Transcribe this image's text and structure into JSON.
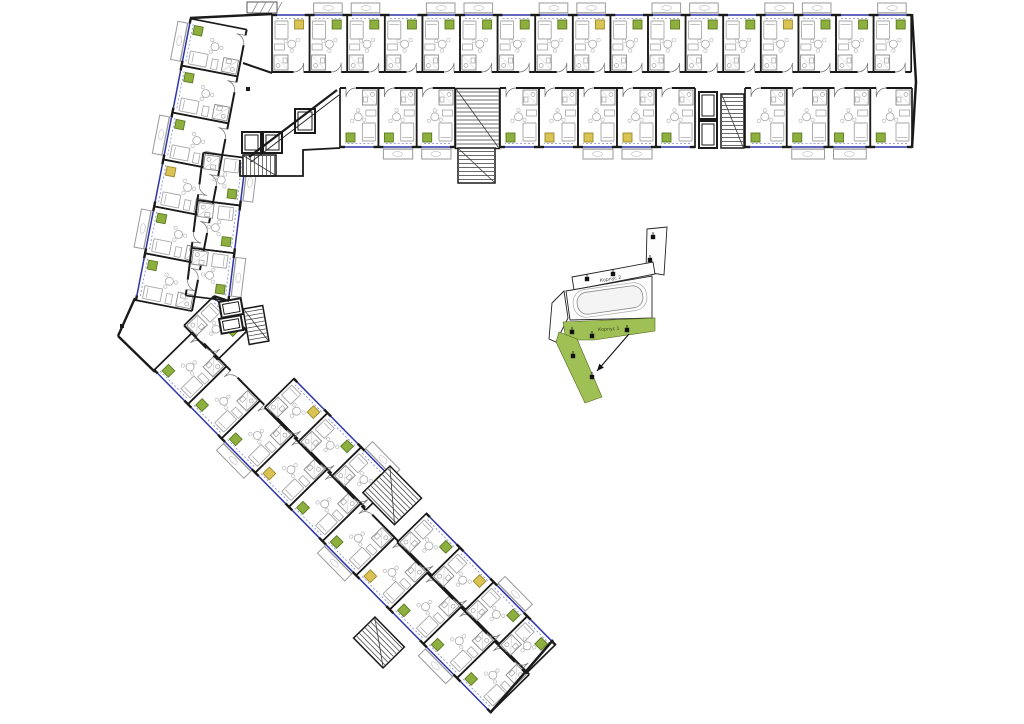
{
  "title": "residential-floor-plan",
  "palette": {
    "wall": "#1a1a1a",
    "furn": "#a6a6a6",
    "furn_light": "#bfbfbf",
    "blue": "#2e35a8",
    "blue_dash": "#8089d6",
    "kitchen_green": "#8caf3e",
    "kitchen_green_dark": "#5d7a22",
    "kitchen_yellow": "#d9c355",
    "kitchen_yellow_dark": "#9b8a2c",
    "stair": "#3a3a3a",
    "minimap_green": "#9fc055",
    "minimap_green_dark": "#55661f",
    "bg": "#ffffff"
  },
  "plan": {
    "rows": [
      {
        "name": "top-wing-north-row",
        "o": [
          272,
          14
        ],
        "a": 0,
        "w": 37.6,
        "d": 58,
        "units": [
          {
            "x": 0,
            "k": "y",
            "bal": false
          },
          {
            "x": 37.6,
            "k": "g",
            "bal": true
          },
          {
            "x": 75.2,
            "k": "g",
            "bal": true
          },
          {
            "x": 112.8,
            "k": "g",
            "bal": false
          },
          {
            "x": 150.4,
            "k": "g",
            "bal": true
          },
          {
            "x": 188,
            "k": "g",
            "bal": true
          },
          {
            "x": 225.6,
            "k": "g",
            "bal": false
          },
          {
            "x": 263.2,
            "k": "g",
            "bal": true
          },
          {
            "x": 300.8,
            "k": "y",
            "bal": true
          },
          {
            "x": 338.4,
            "k": "g",
            "bal": false
          },
          {
            "x": 376,
            "k": "g",
            "bal": true
          },
          {
            "x": 413.6,
            "k": "g",
            "bal": true
          },
          {
            "x": 451.2,
            "k": "g",
            "bal": false
          },
          {
            "x": 488.8,
            "k": "y",
            "bal": true
          },
          {
            "x": 526.4,
            "k": "g",
            "bal": true
          },
          {
            "x": 564,
            "k": "g",
            "bal": false
          },
          {
            "x": 601.6,
            "k": "g",
            "bal": true
          }
        ]
      },
      {
        "name": "top-wing-south-row",
        "o": [
          912,
          148
        ],
        "a": 180,
        "w": 39,
        "d": 60,
        "units": [
          {
            "x": 0,
            "w": 41.75,
            "k": "g",
            "bal": false
          },
          {
            "x": 41.75,
            "w": 41.75,
            "k": "g",
            "bal": true
          },
          {
            "x": 83.5,
            "w": 41.75,
            "k": "g",
            "bal": true
          },
          {
            "x": 125.25,
            "w": 41.75,
            "k": "g",
            "bal": false
          },
          {
            "x": 217,
            "k": "g",
            "bal": false
          },
          {
            "x": 256,
            "k": "y",
            "bal": true
          },
          {
            "x": 295,
            "k": "y",
            "bal": true
          },
          {
            "x": 334,
            "k": "y",
            "bal": false
          },
          {
            "x": 373,
            "k": "g",
            "bal": false
          },
          {
            "x": 457,
            "w": 38.3,
            "k": "g",
            "bal": true
          },
          {
            "x": 495.3,
            "w": 38.3,
            "k": "g",
            "bal": true
          },
          {
            "x": 533.6,
            "w": 38.4,
            "k": "g",
            "bal": false
          }
        ]
      },
      {
        "name": "upper-diagonal-outer-row",
        "o": [
          135,
          300
        ],
        "a": -79,
        "w": 47.8,
        "d": 58,
        "units": [
          {
            "x": 0,
            "k": "g",
            "bal": false
          },
          {
            "x": 47.8,
            "k": "g",
            "bal": true
          },
          {
            "x": 95.6,
            "k": "y",
            "bal": false
          },
          {
            "x": 143.4,
            "k": "g",
            "bal": true
          },
          {
            "x": 191.2,
            "k": "g",
            "bal": false
          },
          {
            "x": 239,
            "k": "g",
            "bal": true
          }
        ]
      },
      {
        "name": "upper-diagonal-inner-row",
        "o": [
          247,
          158
        ],
        "a": 97,
        "w": 48,
        "d": 44,
        "units": [
          {
            "x": 0,
            "k": "g",
            "bal": true
          },
          {
            "x": 48,
            "k": "g",
            "bal": false
          },
          {
            "x": 96,
            "k": "g",
            "bal": true
          }
        ]
      },
      {
        "name": "lower-diagonal-outer-row",
        "o": [
          490,
          713
        ],
        "a": -134.5,
        "w": 48,
        "d": 55,
        "units": [
          {
            "x": 0,
            "k": "g",
            "bal": false
          },
          {
            "x": 48,
            "k": "g",
            "bal": true
          },
          {
            "x": 96,
            "k": "g",
            "bal": false
          },
          {
            "x": 144,
            "k": "y",
            "bal": false
          },
          {
            "x": 192,
            "k": "g",
            "bal": true
          },
          {
            "x": 240,
            "k": "g",
            "bal": false
          },
          {
            "x": 288,
            "k": "y",
            "bal": false
          },
          {
            "x": 336,
            "k": "g",
            "bal": true
          },
          {
            "x": 384,
            "k": "g",
            "bal": false
          },
          {
            "x": 432,
            "k": "g",
            "bal": false
          }
        ]
      },
      {
        "name": "lower-diagonal-inner-row",
        "o": [
          214,
          296
        ],
        "a": 45.5,
        "w": 48,
        "d": 42,
        "units": [
          {
            "x": 0,
            "k": "g",
            "bal": false
          },
          {
            "x": 115,
            "k": "y",
            "bal": false
          },
          {
            "x": 163,
            "k": "g",
            "bal": false
          },
          {
            "x": 211,
            "k": "g",
            "bal": true
          },
          {
            "x": 304,
            "k": "g",
            "bal": false
          },
          {
            "x": 352,
            "k": "y",
            "bal": false
          },
          {
            "x": 400,
            "k": "g",
            "bal": true
          },
          {
            "x": 448,
            "w": 40,
            "k": "g",
            "bal": false
          }
        ]
      }
    ],
    "cores": [
      {
        "x": 455.5,
        "y": 88.5,
        "w": 44,
        "h": 60,
        "a": 0,
        "t": "stair",
        "tr": "h"
      },
      {
        "x": 458,
        "y": 148,
        "w": 37,
        "h": 35,
        "a": 0,
        "t": "stair",
        "tr": "h"
      },
      {
        "x": 699,
        "y": 92,
        "w": 18,
        "h": 27,
        "a": 0,
        "t": "elev"
      },
      {
        "x": 699,
        "y": 121,
        "w": 18,
        "h": 27,
        "a": 0,
        "t": "elev"
      },
      {
        "x": 721,
        "y": 94,
        "w": 23,
        "h": 54,
        "a": 0,
        "t": "stair",
        "tr": "h"
      },
      {
        "x": 242,
        "y": 132,
        "w": 19,
        "h": 21,
        "a": 0,
        "t": "elev"
      },
      {
        "x": 263,
        "y": 132,
        "w": 19,
        "h": 21,
        "a": 0,
        "t": "elev"
      },
      {
        "x": 243,
        "y": 155,
        "w": 33,
        "h": 21,
        "a": 0,
        "t": "stair",
        "tr": "v"
      },
      {
        "x": 295,
        "y": 109,
        "w": 20,
        "h": 24,
        "a": 0,
        "t": "elev"
      },
      {
        "x": 219,
        "y": 302,
        "w": 22,
        "h": 16,
        "a": -10,
        "t": "elev"
      },
      {
        "x": 219,
        "y": 319,
        "w": 22,
        "h": 15,
        "a": -10,
        "t": "elev"
      },
      {
        "x": 243,
        "y": 309,
        "w": 20,
        "h": 36,
        "a": -10,
        "t": "stair",
        "tr": "h"
      },
      {
        "x": 390,
        "y": 466,
        "w": 45,
        "h": 38,
        "a": 45.5,
        "t": "stair",
        "tr": "h"
      },
      {
        "x": 383,
        "y": 668,
        "w": 42,
        "h": 30,
        "a": -134.5,
        "t": "stair",
        "tr": "h"
      },
      {
        "x": 247,
        "y": 2,
        "w": 30,
        "h": 11,
        "a": 0,
        "t": "canopy"
      }
    ],
    "walls": [
      {
        "p": [
          [
            190,
            18
          ],
          [
            272,
            14
          ]
        ],
        "w": 2.4
      },
      {
        "p": [
          [
            272,
            73
          ],
          [
            243,
            63
          ]
        ],
        "w": 2
      },
      {
        "p": [
          [
            249,
            157
          ],
          [
            337,
            90
          ]
        ],
        "w": 2.2
      },
      {
        "p": [
          [
            251,
            162
          ],
          [
            339,
            95
          ]
        ],
        "w": 0.9
      },
      {
        "p": [
          [
            240,
            160
          ],
          [
            240,
            176
          ],
          [
            303,
            176
          ],
          [
            303,
            150
          ],
          [
            340,
            148
          ]
        ],
        "w": 1.8
      },
      {
        "p": [
          [
            135,
            298
          ],
          [
            118,
            336
          ]
        ],
        "w": 2.4
      },
      {
        "p": [
          [
            118,
            336
          ],
          [
            155,
            372
          ]
        ],
        "w": 2.4
      },
      {
        "p": [
          [
            229,
            301
          ],
          [
            214,
            296
          ]
        ],
        "w": 2
      },
      {
        "p": [
          [
            912,
            14
          ],
          [
            916,
            82
          ],
          [
            912,
            148
          ]
        ],
        "w": 2.5
      },
      {
        "p": [
          [
            490,
            713
          ],
          [
            553,
            640
          ]
        ],
        "w": 2.5
      }
    ],
    "dots": [
      [
        248,
        89
      ],
      [
        122,
        326
      ]
    ]
  },
  "keyplan": {
    "building2_label": "Корпус 2",
    "building1_label": "Корпус 1",
    "outline_shapes": [
      {
        "name": "key-bar",
        "pts": [
          [
            647,
            229
          ],
          [
            667,
            227
          ],
          [
            664,
            275
          ],
          [
            646,
            272
          ]
        ]
      },
      {
        "name": "key-band2",
        "pts": [
          [
            572,
            277
          ],
          [
            653,
            262
          ],
          [
            655,
            274
          ],
          [
            574,
            290
          ]
        ]
      },
      {
        "name": "key-body",
        "pts": [
          [
            566,
            291
          ],
          [
            652,
            276
          ],
          [
            652,
            318
          ],
          [
            570,
            320
          ]
        ]
      },
      {
        "name": "key-tail",
        "pts": [
          [
            552,
            303
          ],
          [
            564,
            291
          ],
          [
            568,
            318
          ],
          [
            556,
            342
          ],
          [
            549,
            339
          ]
        ]
      }
    ],
    "green_shapes": [
      {
        "name": "key-band1",
        "pts": [
          [
            563,
            322
          ],
          [
            655,
            318
          ],
          [
            655,
            331
          ],
          [
            594,
            340
          ],
          [
            566,
            340
          ]
        ]
      },
      {
        "name": "key-arm",
        "pts": [
          [
            559,
            332
          ],
          [
            577,
            339
          ],
          [
            602,
            397
          ],
          [
            585,
            403
          ],
          [
            556,
            342
          ]
        ]
      }
    ],
    "entrances": [
      [
        653,
        237
      ],
      [
        650,
        260
      ],
      [
        587,
        279
      ],
      [
        613,
        274
      ],
      [
        572,
        332
      ],
      [
        592,
        336
      ],
      [
        627,
        330
      ],
      [
        573,
        356
      ],
      [
        592,
        377
      ]
    ],
    "arrow": {
      "from": [
        629,
        334
      ],
      "to": [
        597,
        371
      ]
    },
    "courtyard": {
      "cx": 610,
      "cy": 300,
      "rot": -8,
      "rx1": [
        66,
        22,
        10
      ],
      "rx2": [
        74,
        28,
        13
      ]
    }
  }
}
